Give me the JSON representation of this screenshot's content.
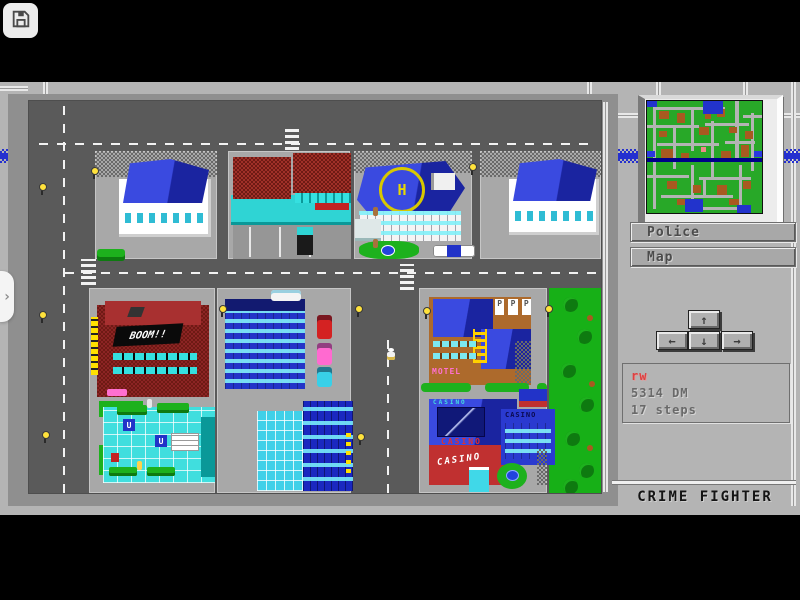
{
  "browser": {
    "save_button": {
      "icon": "floppy-disk"
    },
    "side_panel_toggle": {
      "icon": "chevron-right",
      "glyph": "›"
    }
  },
  "hud": {
    "buttons": [
      {
        "label": "Police"
      },
      {
        "label": "Map"
      }
    ],
    "dpad": {
      "up": "↑",
      "left": "←",
      "down": "↓",
      "right": "→"
    },
    "status": {
      "player_name": "rw",
      "money": "5314 DM",
      "steps": "17 steps"
    },
    "title": "CRIME FIGHTER",
    "minimap": {
      "player_marker_color": "#f08888"
    }
  },
  "city": {
    "signs": {
      "disco": "BOOM!!",
      "motel": "MOTEL",
      "casino_marquee": "CASINO",
      "casino_roof": "CASINO",
      "casino_wall": "CASINO",
      "casino_wing": "CASINO",
      "parking_p": "P",
      "helipad": "H",
      "metro_u": "U"
    }
  },
  "colors": {
    "background_gray": "#b4b4b4",
    "street_gray": "#5a5a5a",
    "river_blue": "#2530cf",
    "minimap_green": "#28a828",
    "minimap_brown": "#a85a20",
    "roof_blue": "#2a3ad0",
    "casino_red": "#c03030",
    "lawn_green": "#1db11d",
    "player_name_red": "#e04040"
  }
}
